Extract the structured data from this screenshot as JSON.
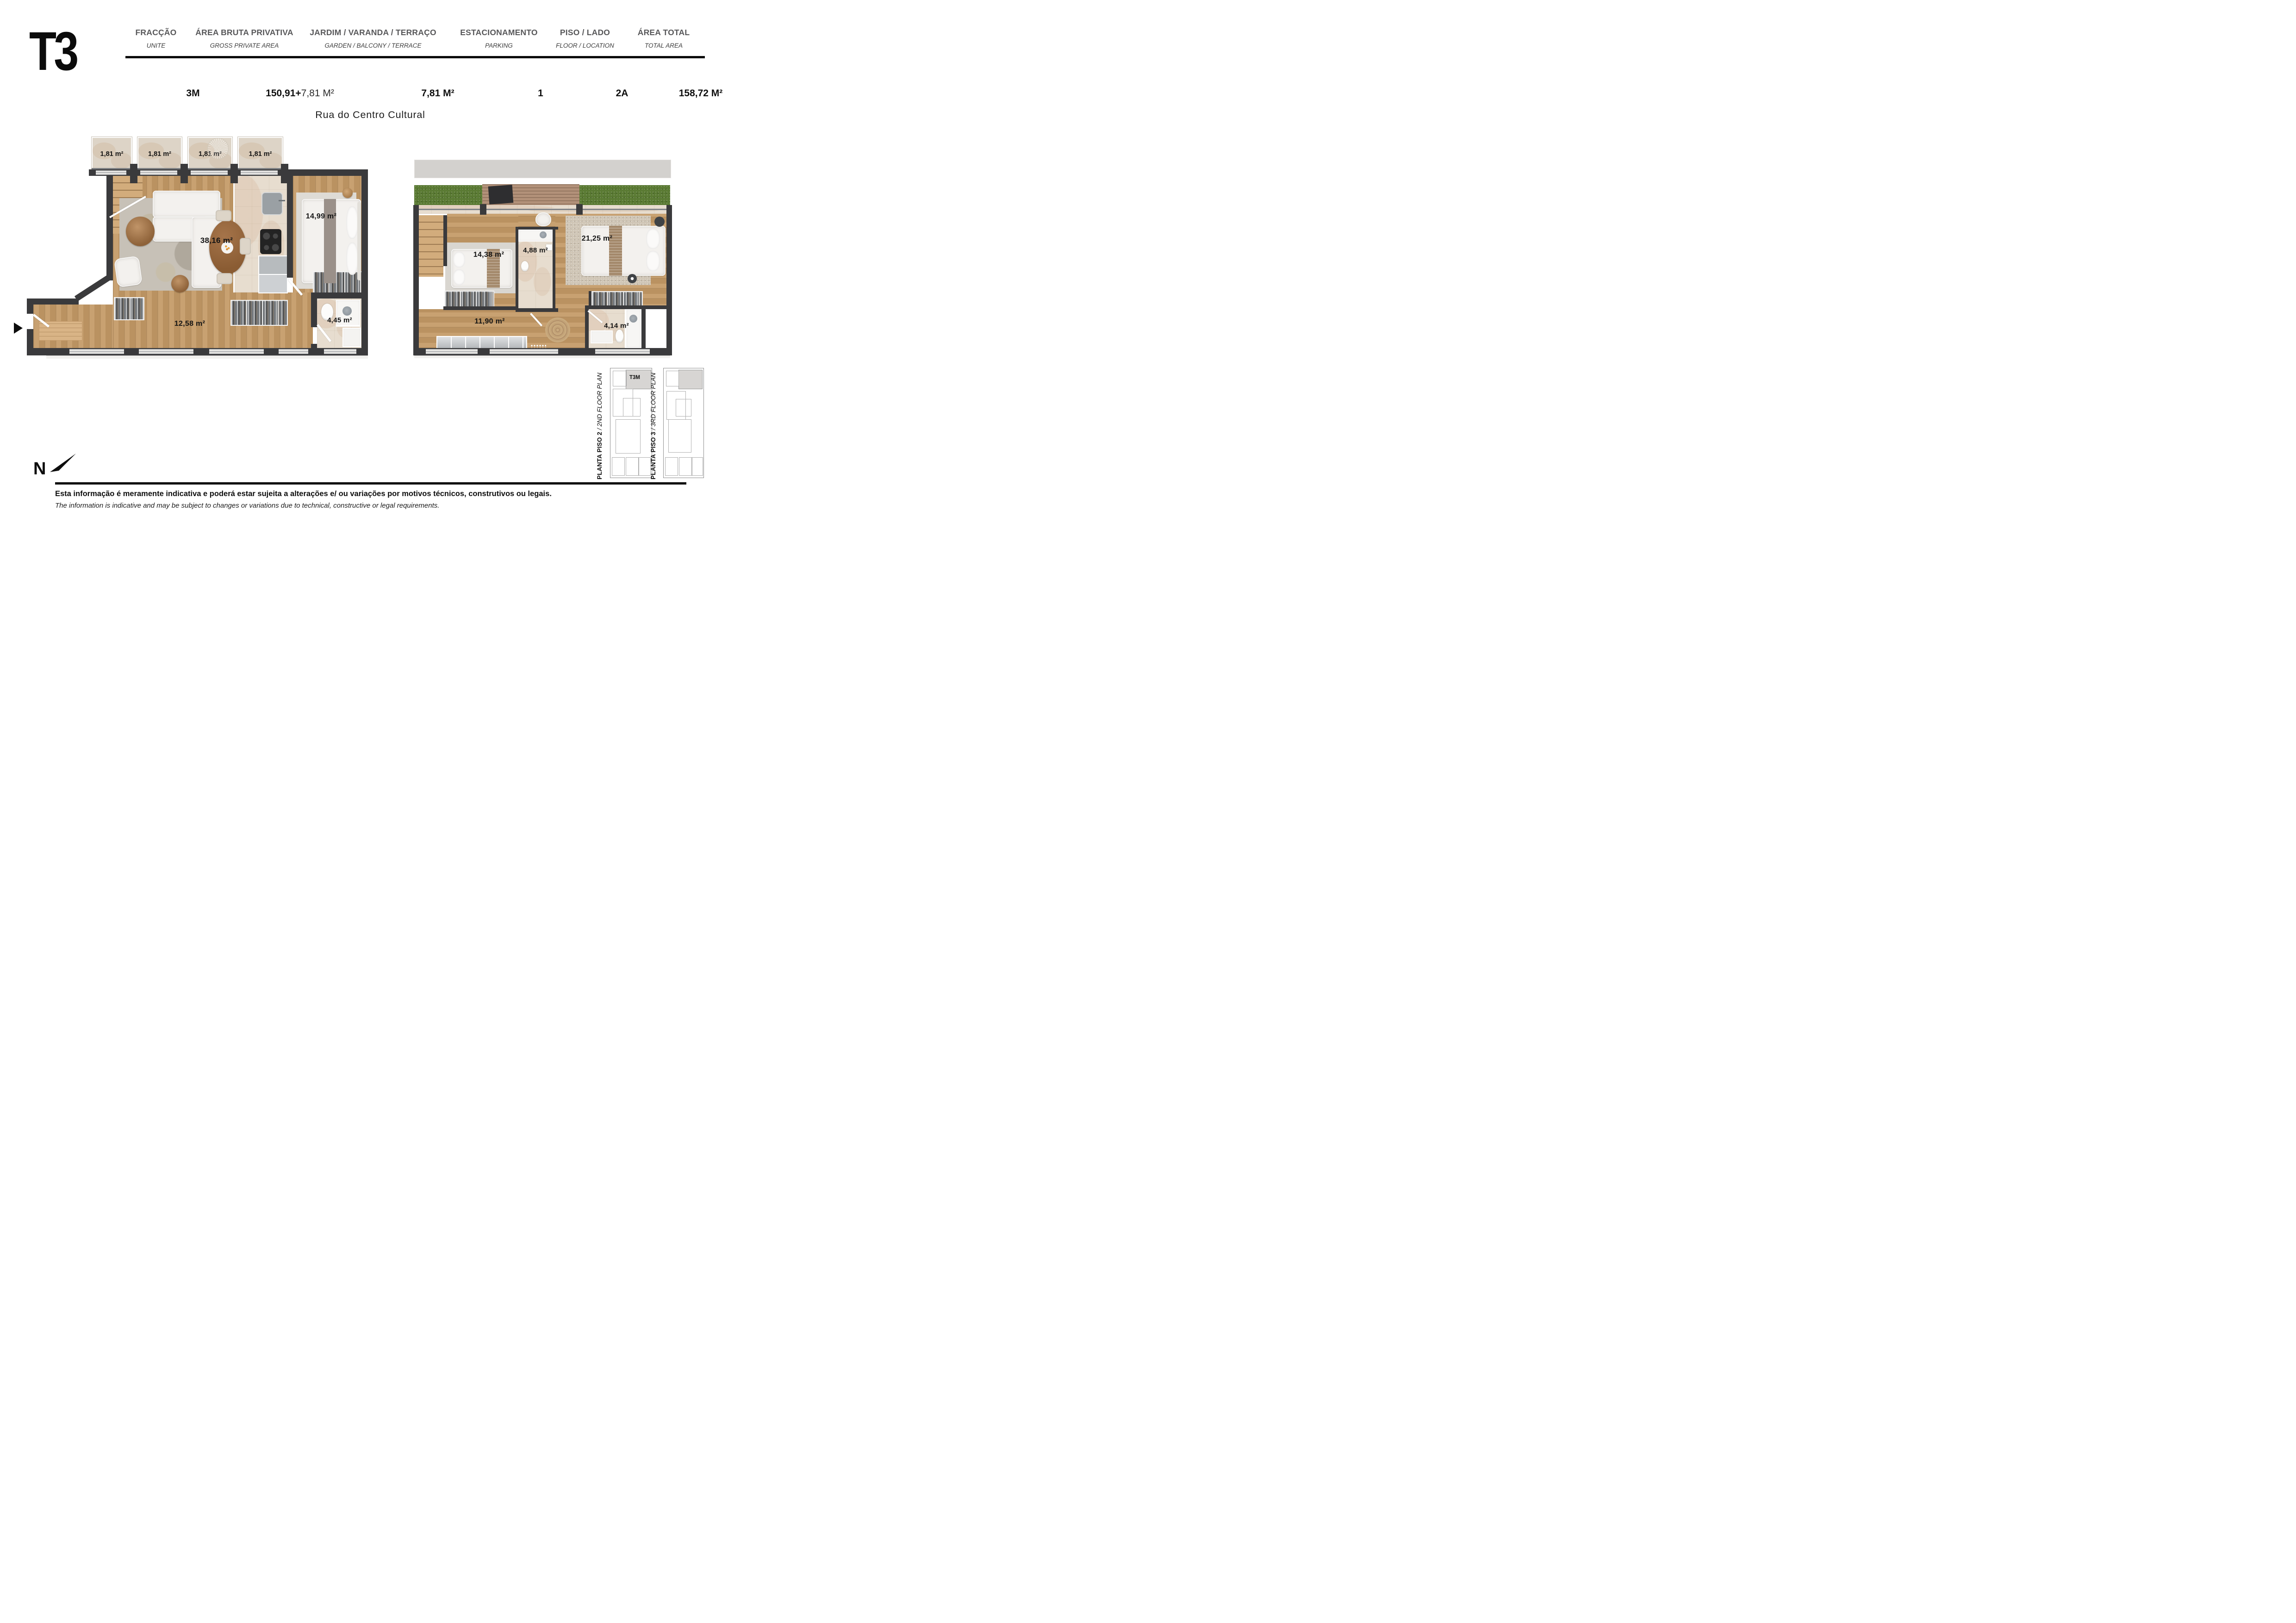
{
  "header": {
    "brand": "T3",
    "columns": [
      {
        "pt": "FRACÇÃO",
        "en": "UNITE",
        "value": "3M"
      },
      {
        "pt": "ÁREA BRUTA PRIVATIVA",
        "en": "GROSS PRIVATE AREA",
        "value_bold": "150,91+",
        "value_light": "7,81 M²"
      },
      {
        "pt": "JARDIM / VARANDA / TERRAÇO",
        "en": "GARDEN / BALCONY / TERRACE",
        "value": "7,81  M²"
      },
      {
        "pt": "ESTACIONAMENTO",
        "en": "PARKING",
        "value": "1"
      },
      {
        "pt": "PISO / LADO",
        "en": "FLOOR / LOCATION",
        "value": "2A"
      },
      {
        "pt": "ÁREA TOTAL",
        "en": "TOTAL AREA",
        "value": "158,72  M²"
      }
    ]
  },
  "street": "Rua do Centro Cultural",
  "plan_floor2": {
    "balconies": [
      "1,81 m²",
      "1,81 m²",
      "1,81 m²",
      "1,81 m²"
    ],
    "living": "38,16 m²",
    "bedroom": "14,99 m²",
    "hall": "12,58 m²",
    "bathroom": "4,45 m²"
  },
  "plan_floor3": {
    "bedroom_left": "14,38 m²",
    "bathroom": "4,88 m²",
    "bedroom_right": "21,25 m²",
    "hall": "11,90 m²",
    "bathroom_2": "4,14 m²"
  },
  "mini_plans": [
    {
      "title_bold": "PLANTA PISO 2",
      "title_italic": " / 2ND FLOOR PLAN",
      "unit_tag": "T3M"
    },
    {
      "title_bold": "PLANTA PISO 3",
      "title_italic": " / 3RD FLOOR PLAN"
    }
  ],
  "compass_letter": "N",
  "disclaimer": {
    "pt": "Esta informação é meramente indicativa e poderá estar sujeita a alterações e/ ou variações por motivos técnicos, construtivos ou legais.",
    "en": "The information is indicative and may be subject to changes or variations due to technical, constructive or legal requirements."
  },
  "palette": {
    "wall": "#3a3a3c",
    "wood": "#c49a66",
    "stone": "#e7ddcf",
    "grass": "#5a7a33",
    "highlight": "#d7d5d3"
  }
}
